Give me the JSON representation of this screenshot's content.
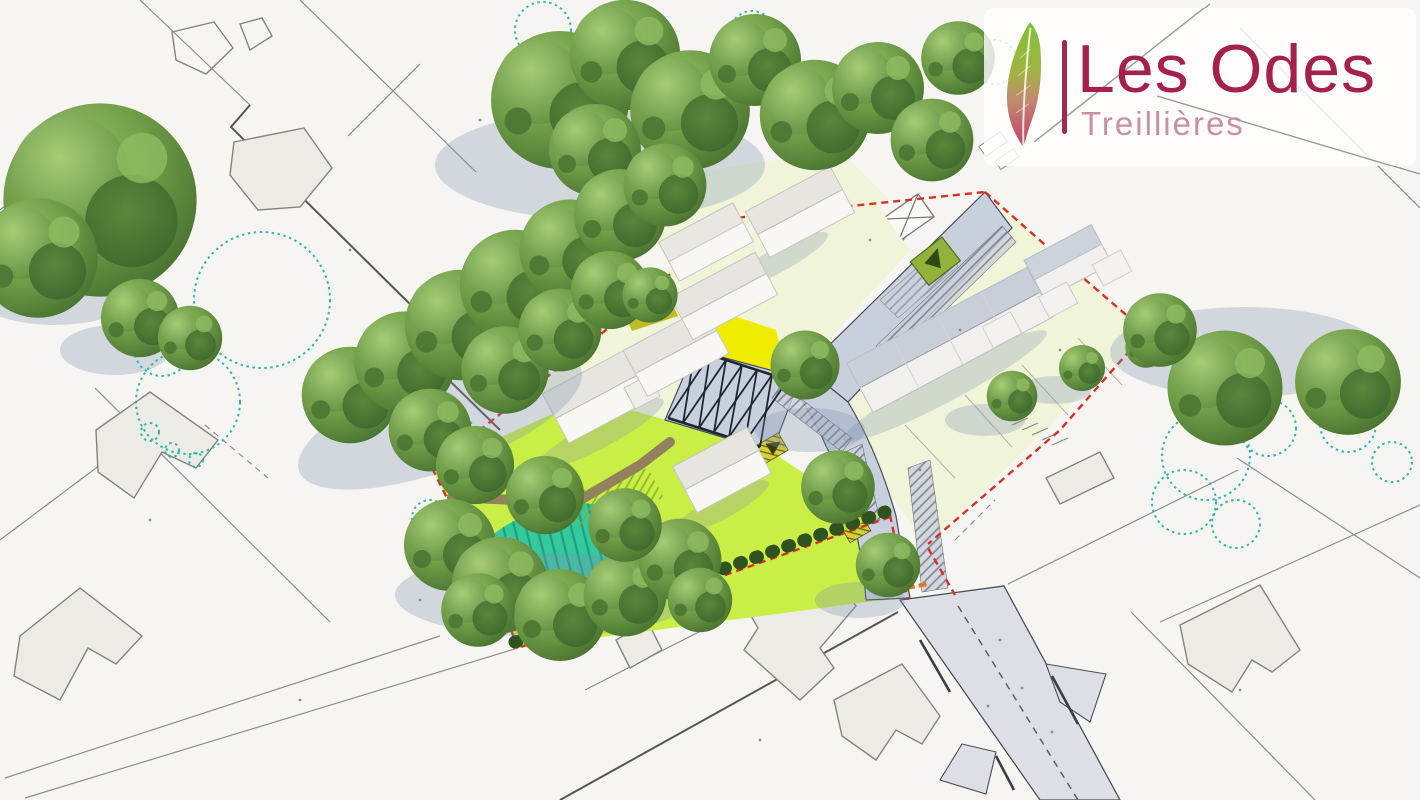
{
  "logo": {
    "title": "Les Odes",
    "subtitle": "Treillières",
    "icon": "feather-icon",
    "colors": {
      "title": "#a6204e",
      "subtitle": "#c9909f",
      "bar": "#9c2a52",
      "feather_top": "#7fc133",
      "feather_bottom": "#bb4f63",
      "box_bg": "rgba(255,255,255,0.80)"
    }
  },
  "scene": {
    "type": "aerial-3d-masterplan-render",
    "colors": {
      "paper": "#f7f5f1",
      "parcel_line": "#8f8d89",
      "wall_line": "#57554f",
      "footprint_fill": "#ecebe6",
      "site_boundary_red": "#d93025",
      "road_fill": "#c9d0dd",
      "public_road_fill": "#dcdfe5",
      "road_edge": "#454b56",
      "lawn_pale": "#f0f5da",
      "lawn_lime": "#c9ee45",
      "plaza_yellow": "#f0ec00",
      "olive_patch": "#b9b614",
      "basin_teal": "#35c9a0",
      "basin_stripe": "#0f8463",
      "path_brown": "#93815d",
      "hedge_dark": "#2e5220",
      "hedge_strip": "#d9ea3c",
      "trellis_dark": "#1c2732",
      "scrub_teal": "#27b3ab",
      "shadow_blue": "#7e90ad",
      "parking_green": "#93b23c",
      "orange_curb": "#e07820"
    },
    "features": [
      "existing-parcel-lines",
      "existing-building-footprints",
      "existing-trees",
      "heritage-vegetation-outlines",
      "site-boundary-red-dashed",
      "shared-street",
      "central-square-pergola",
      "stormwater-basin",
      "meadow-park",
      "hedge-row",
      "new-house-volumes",
      "private-gardens",
      "parking-pads",
      "main-road-centerline"
    ]
  }
}
